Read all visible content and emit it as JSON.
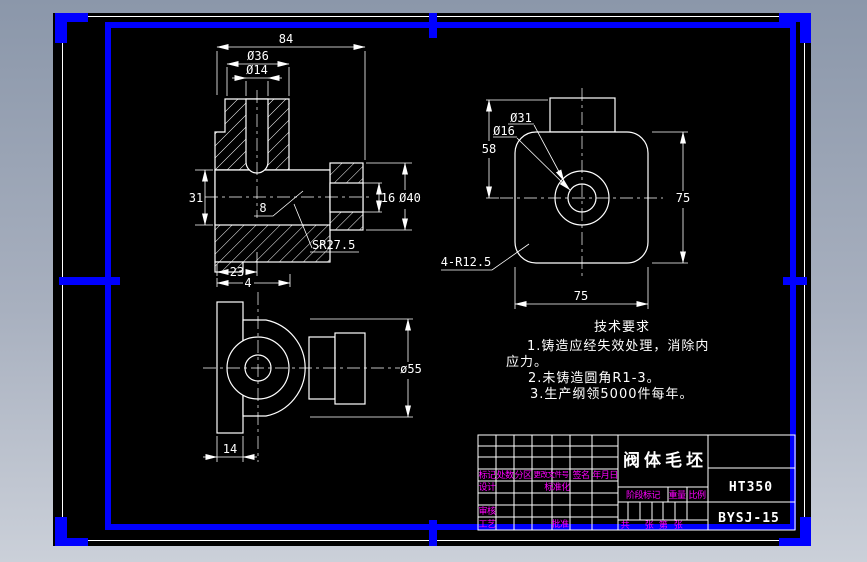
{
  "colors": {
    "canvas": "#000000",
    "line": "#ffffff",
    "frame_and_grips": "#0000ff",
    "label_magenta": "#ff00ff",
    "desktop_top": "#8b97aa",
    "desktop_bottom": "#cbd0d9"
  },
  "front_view": {
    "dim_84": "84",
    "dim_d36": "Ø36",
    "dim_d14": "Ø14",
    "dim_31": "31",
    "dim_8": "8",
    "dim_16": "16",
    "dim_d40": "Ø40",
    "dim_sr275": "SR27.5",
    "dim_23": "23",
    "dim_4": "4"
  },
  "side_view": {
    "dim_d31": "Ø31",
    "dim_d16": "Ø16",
    "dim_58": "58",
    "dim_75_right": "75",
    "dim_75_bottom": "75",
    "dim_corner_r": "4-R12.5"
  },
  "bottom_view": {
    "dim_d55": "ø55",
    "dim_14": "14"
  },
  "tech_req": {
    "title": "技术要求",
    "line1": "1.铸造应经失效处理，消除内",
    "line2": "应力。",
    "line3": "2.未铸造圆角R1-3。",
    "line4": "3.生产纲领5000件每年。"
  },
  "title_block": {
    "part_name": "阀体毛坯",
    "material": "HT350",
    "drawing_no": "BYSJ-15",
    "rev_header": {
      "mark": "标记",
      "count": "处数",
      "zone": "分区",
      "change_file": "更改文件号",
      "signature": "签名",
      "date": "年月日"
    },
    "roles": {
      "design": "设计",
      "standardization": "标准化",
      "check": "审核",
      "process": "工艺",
      "approve": "批准"
    },
    "meta": {
      "stage_mark": "阶段标记",
      "weight": "重量",
      "scale": "比例",
      "sheet_total_label": "共",
      "sheet_total_unit": "张",
      "sheet_no_label": "第",
      "sheet_no_unit": "张"
    }
  }
}
